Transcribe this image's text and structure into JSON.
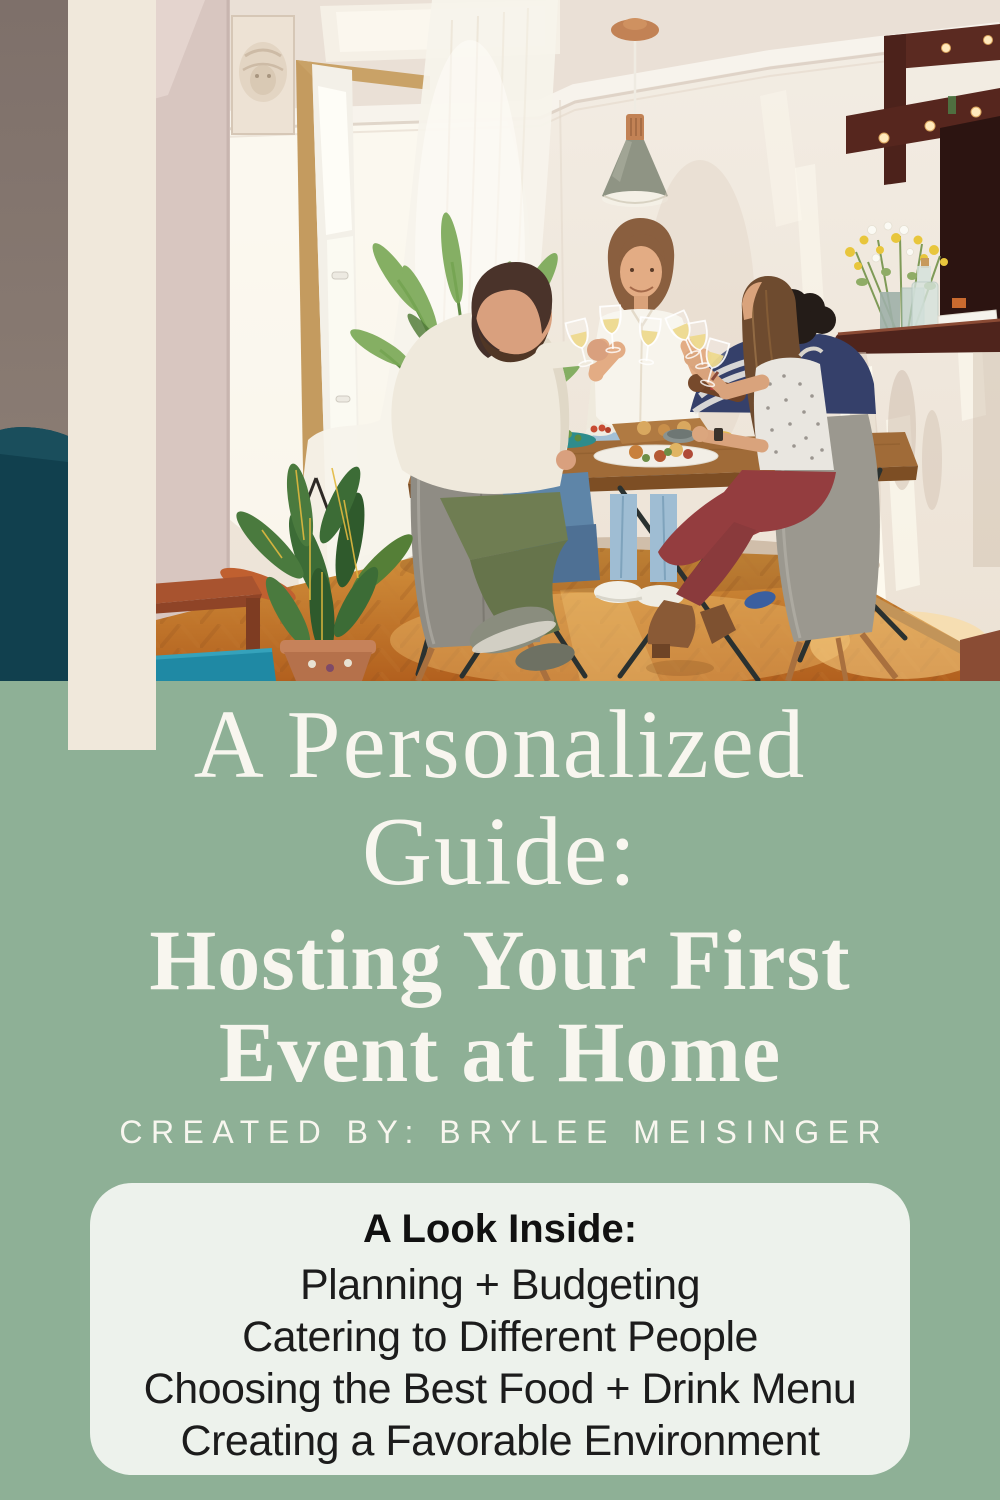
{
  "theme": {
    "green": "#8EB096",
    "cream_bar": "#F0E8DB",
    "card_bg": "#EDF2EC",
    "title_color": "#F8F6EF",
    "card_text": "#1C1C1C"
  },
  "hero_photo": {
    "description": "Four friends toasting with glasses of white wine around a wooden dining table with food, in a bright home dining room with a pendant lamp, sheer curtains, plants and a bar counter with flowers"
  },
  "title": {
    "script_lines": [
      "A Personalized",
      "Guide:"
    ],
    "serif_lines": [
      "Hosting Your First",
      "Event at Home"
    ],
    "byline": "CREATED BY: BRYLEE MEISINGER"
  },
  "card": {
    "heading": "A Look Inside:",
    "items": [
      "Planning + Budgeting",
      "Catering to Different People",
      "Choosing the Best Food + Drink Menu",
      "Creating a Favorable Environment"
    ]
  }
}
